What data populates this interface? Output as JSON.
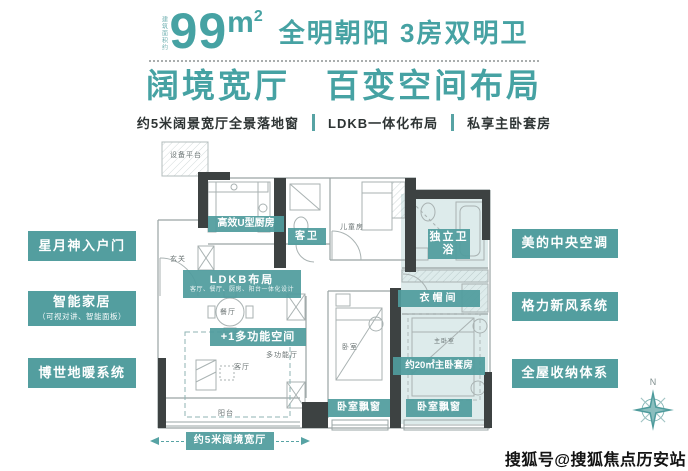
{
  "colors": {
    "accent_teal": "#46a2a3",
    "tag_teal": "#539e9f",
    "wall_dark": "#3d4242",
    "line_gray": "#a9b2b2",
    "suite_tint": "#d2e4e4",
    "ink": "#2e3434"
  },
  "header": {
    "area_note": "建筑面积约",
    "area_value": "99",
    "area_unit_letter": "m",
    "area_unit_sup": "2",
    "headline": "全明朝阳 3房双明卫",
    "title": "阔境宽厅　百变空间布局",
    "features": [
      {
        "label": "约5米阔景宽厅全景落地窗"
      },
      {
        "label": "LDKB一体化布局"
      },
      {
        "label": "私享主卧套房"
      }
    ]
  },
  "left_tags": [
    {
      "label": "星月神入户门",
      "sub": ""
    },
    {
      "label": "智能家居",
      "sub": "（可视对讲、智能面板）"
    },
    {
      "label": "博世地暖系统",
      "sub": ""
    }
  ],
  "right_tags": [
    {
      "label": "美的中央空调"
    },
    {
      "label": "格力新风系统"
    },
    {
      "label": "全屋收纳体系"
    }
  ],
  "plan": {
    "tags": [
      {
        "text": "高效U型厨房"
      },
      {
        "text": "客卫"
      },
      {
        "text": "独立卫浴"
      },
      {
        "text": "LDKB布局",
        "sub": "客厅、餐厅、厨房、阳台一体化设计"
      },
      {
        "text": "+1多功能空间"
      },
      {
        "text": "衣帽间"
      },
      {
        "text": "约20㎡主卧套房"
      },
      {
        "text": "卧室飘窗"
      },
      {
        "text": "卧室飘窗"
      }
    ],
    "measure_label": "约5米阔境宽厅",
    "rooms": [
      {
        "text": "设备平台"
      },
      {
        "text": "玄关"
      },
      {
        "text": "儿童房"
      },
      {
        "text": "餐厅"
      },
      {
        "text": "多功能厅"
      },
      {
        "text": "客厅"
      },
      {
        "text": "阳台"
      },
      {
        "text": "卧室"
      },
      {
        "text": "主卧室"
      }
    ]
  },
  "compass": {
    "north_label": "N"
  },
  "watermark": {
    "text": "搜狐号@搜狐焦点历安站"
  }
}
